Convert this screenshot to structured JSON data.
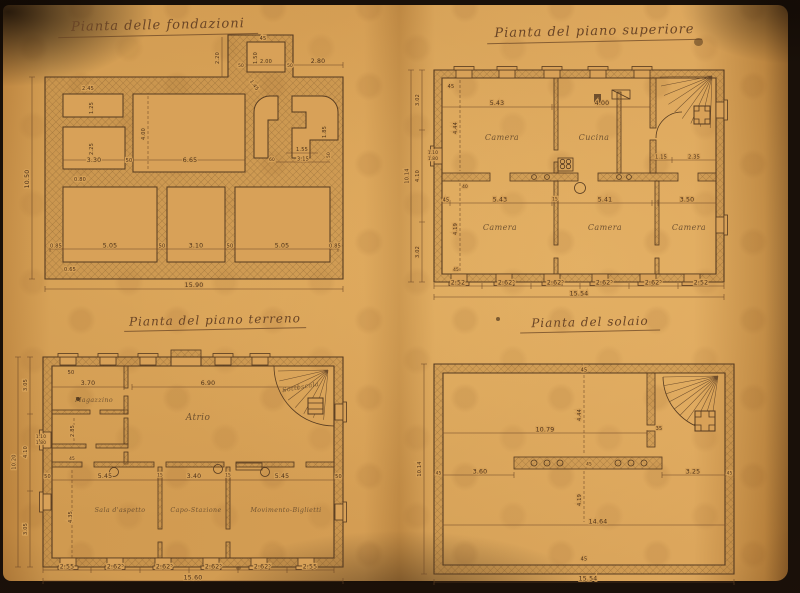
{
  "palette": {
    "paper": "#d7a057",
    "ink": "#4e3118"
  },
  "plans": {
    "fondazioni": {
      "title": "Pianta delle fondazioni",
      "dims": {
        "w_245": "2.45",
        "v_125": "1.25",
        "v_225": "2.25",
        "w_330": "3.30",
        "g_50": "50",
        "w_665": "6.65",
        "v_400": "4.00",
        "v_080": "0.80",
        "p_45": "45",
        "p_150": "1.50",
        "p_200": "2.00",
        "p_50l": "50",
        "p_50r": "50",
        "p_220": "2.20",
        "p_280": "2.80",
        "p_145": "1.45",
        "s_155": "1.55",
        "s_315": "3.15",
        "s_60": "60",
        "s_185": "1.85",
        "s_50": "50",
        "b_085l": "0.85",
        "b_505l": "5.05",
        "b_50a": "50",
        "b_310": "3.10",
        "b_50b": "50",
        "b_505r": "5.05",
        "b_085r": "0.85",
        "b_065": "0.65",
        "total_w": "15.90",
        "total_h": "10.50"
      }
    },
    "superiore": {
      "title": "Pianta del piano superiore",
      "rooms": {
        "camera_nw": "Camera",
        "cucina": "Cucina",
        "camera_sw": "Camera",
        "camera_s": "Camera",
        "camera_se": "Camera"
      },
      "dims": {
        "t_45": "45",
        "t_543": "5.43",
        "t_400": "4.00",
        "s_115": "1.15",
        "s_235": "2.35",
        "v_444": "4.44",
        "v_419": "4.19",
        "w_40": "40",
        "w_45": "45",
        "m_45": "45",
        "m_543": "5.43",
        "m_15": "15",
        "m_541": "5.41",
        "m_350": "3.50",
        "win_110": "1.10",
        "win_180": "1.80",
        "b_252l": "2.52",
        "b_2625a": "2.62⁵",
        "b_2625b": "2.62⁵",
        "b_2625c": "2.62⁵",
        "b_2625d": "2.62⁵",
        "b_252r": "2.52",
        "total_w": "15.54",
        "l_302a": "3.02",
        "l_410": "4.10",
        "l_302b": "3.02",
        "total_h": "10.14"
      }
    },
    "terreno": {
      "title": "Pianta del piano terreno",
      "rooms": {
        "magazzino": "Magazzino",
        "atrio": "Atrio",
        "sottoscala": "Sottoscala",
        "sala": "Sala d'aspetto",
        "capo": "Capo-Stazione",
        "movimento": "Movimento-Biglietti"
      },
      "dims": {
        "t_50": "50",
        "t_370": "3.70",
        "t_690": "6.90",
        "v_285": "2.85",
        "v_45": "45",
        "v_435": "4.35",
        "m_50l": "50",
        "m_545l": "5.45",
        "m_15a": "15",
        "m_340": "3.40",
        "m_15b": "15",
        "m_545r": "5.45",
        "m_50r": "50",
        "win_110": "1.10",
        "win_180": "1.80",
        "b_255l": "2.55",
        "b_2625a": "2.62⁵",
        "b_2625b": "2.62⁵",
        "b_2625c": "2.62⁵",
        "b_2625d": "2.62⁵",
        "b_255r": "2.55",
        "total_w": "15.60",
        "l_305a": "3.05",
        "l_410": "4.10",
        "l_305b": "3.05",
        "total_h": "10.20"
      }
    },
    "solaio": {
      "title": "Pianta del solaio",
      "dims": {
        "t_45": "45",
        "w_1079": "10.79",
        "v_444": "4.44",
        "s_35": "35",
        "m_45l": "45",
        "m_360": "3.60",
        "c_45": "45",
        "m_325": "3.25",
        "m_45r": "45",
        "v_419": "4.19",
        "w_1464": "14.64",
        "b_45": "45",
        "total_w": "15.54",
        "total_h": "10.14"
      }
    }
  }
}
